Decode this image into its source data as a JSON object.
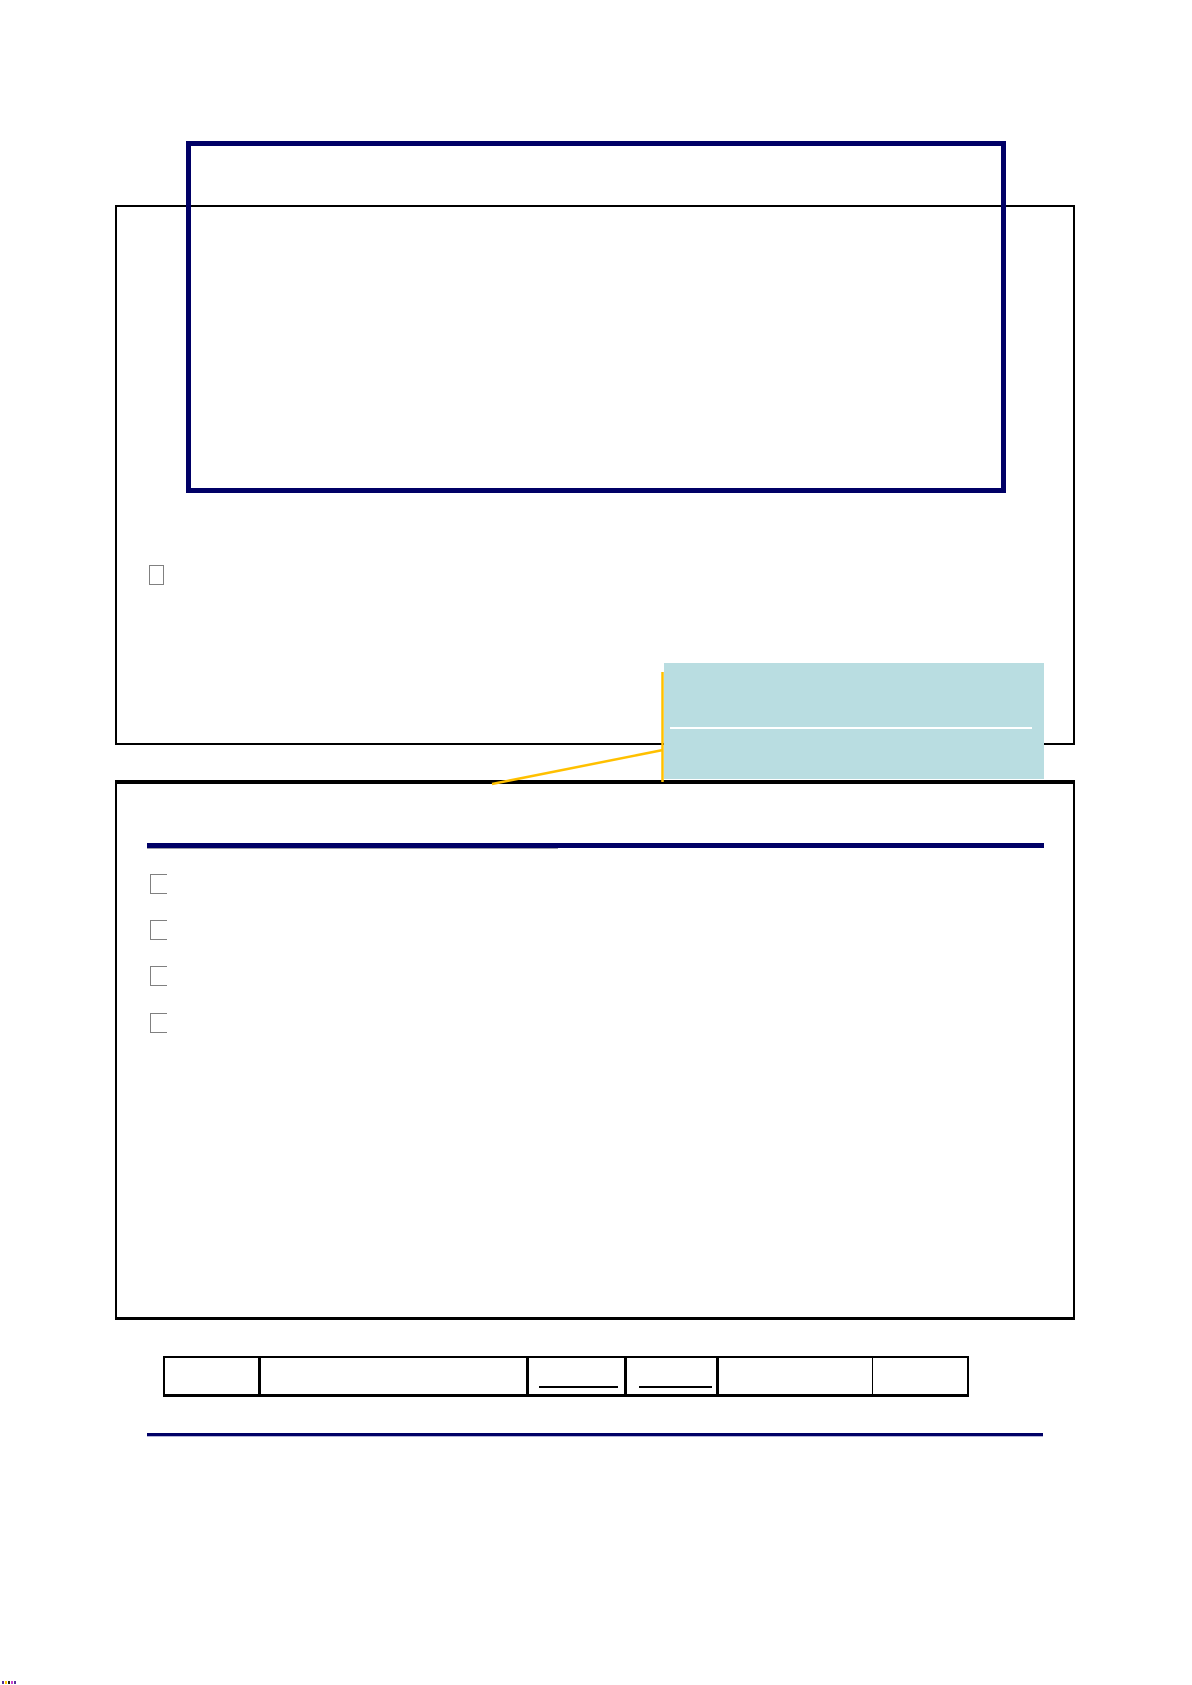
{
  "document": {
    "type": "blank-form-page",
    "visible_text": "",
    "upper_section": {
      "title_frame_text": "",
      "checkboxes": [
        {
          "checked": false,
          "label": ""
        }
      ],
      "callout_box": {
        "text": "",
        "has_blank_underline": true
      }
    },
    "lower_section": {
      "heading_rule": true,
      "checkboxes": [
        {
          "checked": false,
          "label": ""
        },
        {
          "checked": false,
          "label": ""
        },
        {
          "checked": false,
          "label": ""
        },
        {
          "checked": false,
          "label": ""
        }
      ]
    },
    "footer_table": {
      "column_count": 6,
      "cells": [
        {
          "text": "",
          "underlined_blank": false
        },
        {
          "text": "",
          "underlined_blank": false
        },
        {
          "text": "",
          "underlined_blank": true
        },
        {
          "text": "",
          "underlined_blank": true
        },
        {
          "text": "",
          "underlined_blank": false
        },
        {
          "text": "",
          "underlined_blank": false
        }
      ]
    }
  },
  "colors": {
    "page-bg": "#ffffff",
    "black": "#000000",
    "navy": "#000066",
    "teal": "#b9dde1",
    "orange": "#ffc000",
    "cb-gray": "#808080",
    "white": "#ffffff",
    "rule-gray": "#9e9ea8",
    "lavender": "#b3b3d9"
  },
  "corner_mark_colors": [
    "#553399",
    "#ffcc00",
    "#222222",
    "#cc44cc",
    "#553399"
  ]
}
